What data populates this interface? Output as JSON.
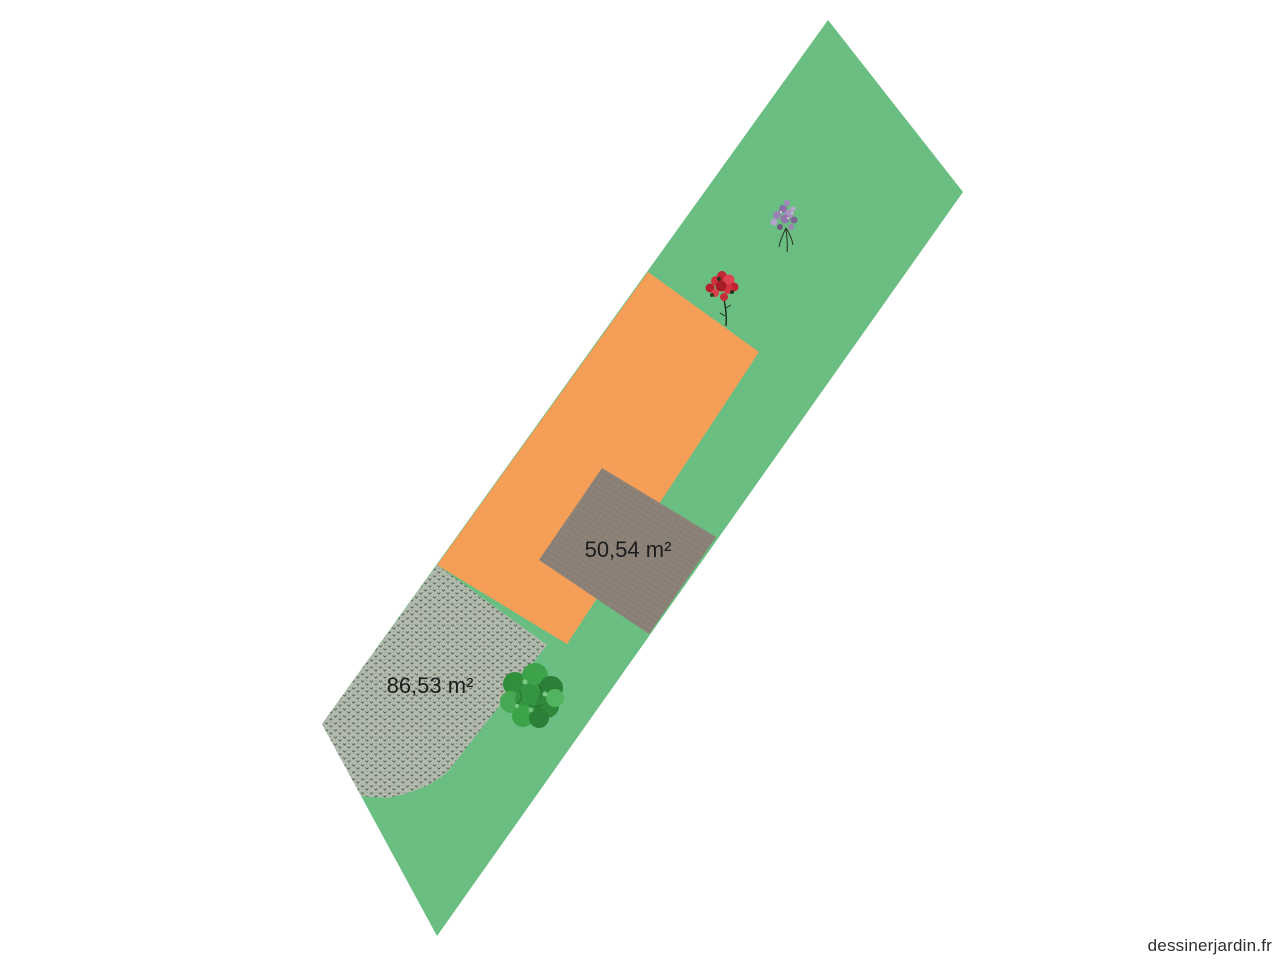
{
  "colors": {
    "background": "#ffffff",
    "lawn": "#6abe81",
    "house": "#f59e58",
    "gravel_base": "#b2baad",
    "gravel_mark": "#3f4a3f",
    "terrace_base": "#8b8177",
    "terrace_line": "#7d746a",
    "terrace_line_light": "#978d83",
    "label_text": "#1c1c1c",
    "watermark_text": "#2e2e2e"
  },
  "areas": {
    "terrace_label": "50,54 m²",
    "gravel_label": "86,53 m²"
  },
  "plants": {
    "tree": "green-tree",
    "red_shrub": "red-flowering-shrub",
    "lilac_shrub": "lilac-flowering-shrub"
  },
  "watermark": "dessinerjardin.fr"
}
